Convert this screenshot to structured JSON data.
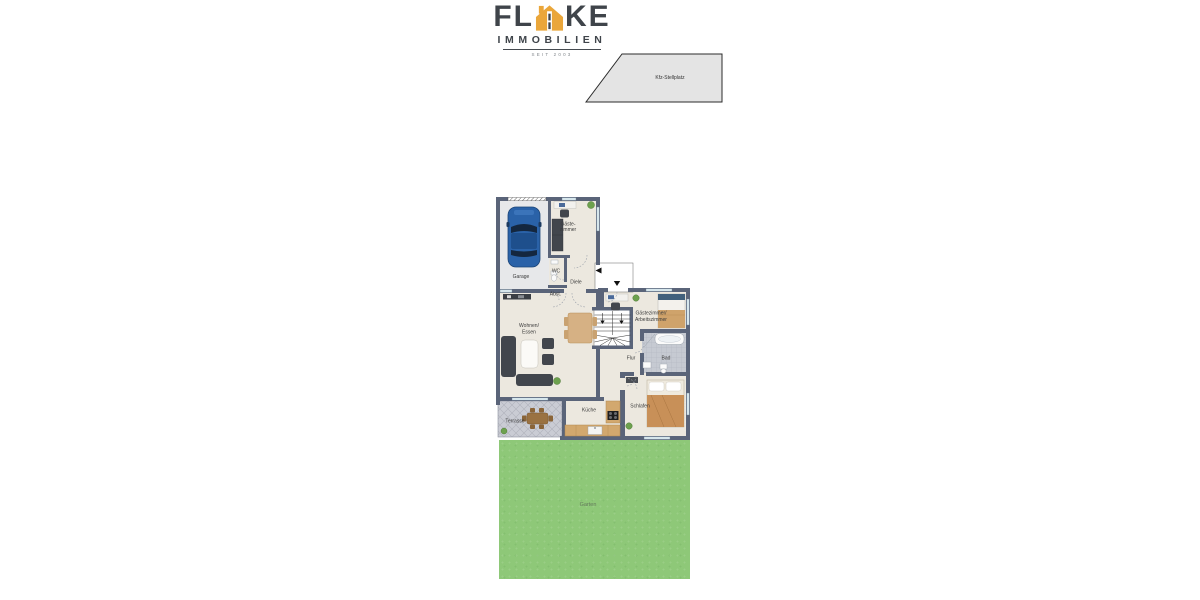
{
  "brand": {
    "name_left": "FL",
    "name_right": "KE",
    "subtitle": "IMMOBILIEN",
    "tagline": "SEIT 2003"
  },
  "site": {
    "parking": "Kfz-Stellplatz",
    "garden": "Garten"
  },
  "floorplan": {
    "rooms": {
      "garage": "Garage",
      "guest_room": {
        "line1": "Gäste-",
        "line2": "zimmer"
      },
      "wc": "WC",
      "entry_hall": "Diele",
      "storage": "Abst.",
      "living_dining": {
        "line1": "Wohnen/",
        "line2": "Essen"
      },
      "guest_office": {
        "line1": "Gästezimmer/",
        "line2": "Arbeitszimmer"
      },
      "hallway": "Flur",
      "bath": "Bad",
      "kitchen": "Küche",
      "bedroom": "Schlafen",
      "terrace": "Terrasse"
    }
  },
  "colors": {
    "wall": "#5a6479",
    "floor": "#ece8df",
    "garage_floor": "#e7e8ea",
    "terrace": "#caccd4",
    "garden": "#8ec878",
    "logo_accent": "#eaa63a",
    "logo_text": "#3f444a",
    "wood": "#d2a86e",
    "dark_furniture": "#42464d"
  }
}
